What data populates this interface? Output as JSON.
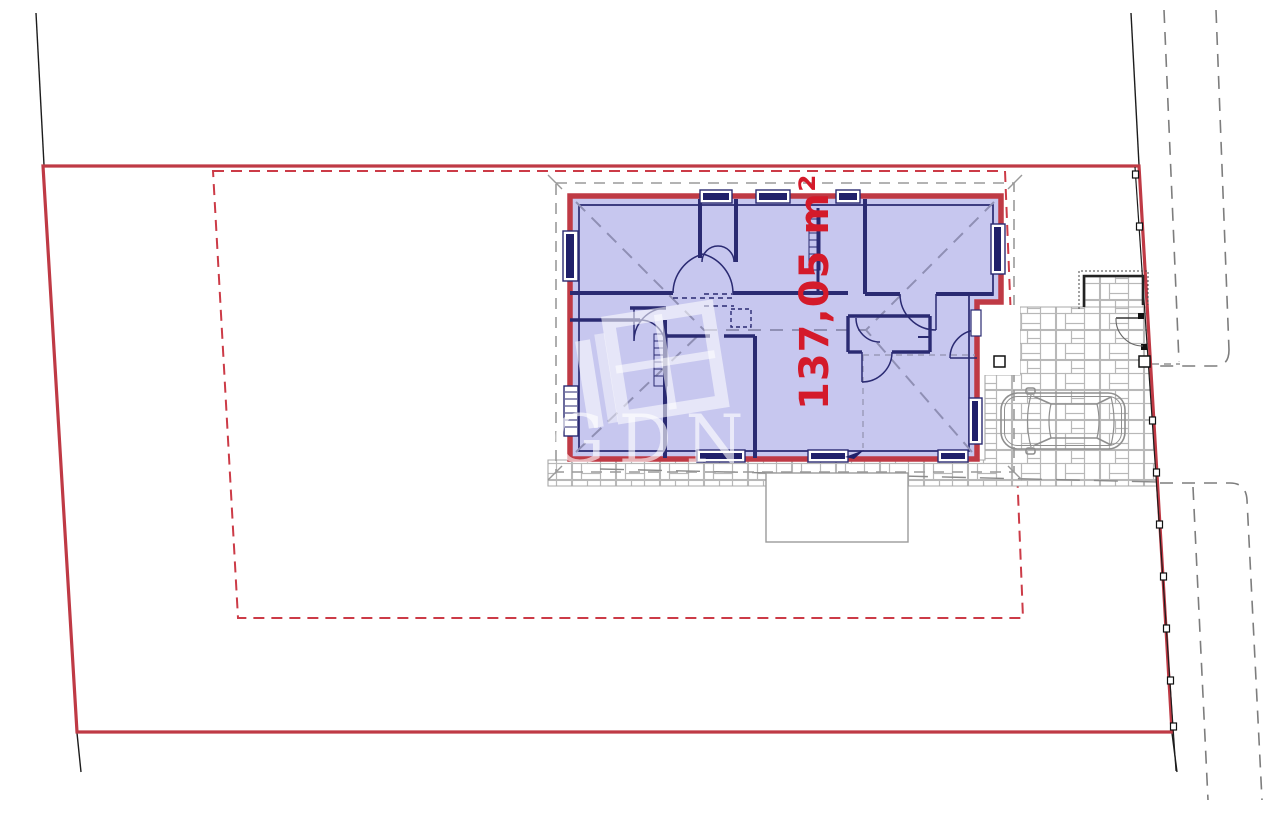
{
  "drawing": {
    "type": "architectural-site-plan",
    "area_label": "137,05 m²",
    "watermark_text": "GDN",
    "colors": {
      "plot_boundary": "#bf3a45",
      "setback_dashed": "#cc3b47",
      "house_fill": "#c7c7ef",
      "house_wall": "#2a2a72",
      "area_label_text": "#d41a2a",
      "roof_dash": "#8f8fb4",
      "paving_line": "#b8b8b8",
      "road_dash": "#7d7d7d"
    }
  }
}
